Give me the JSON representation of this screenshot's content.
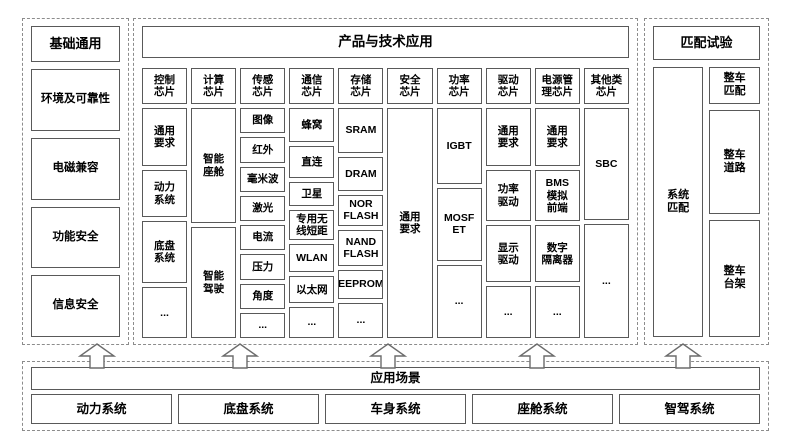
{
  "colors": {
    "background": "#ffffff",
    "box_border": "#595959",
    "dashed_border": "#8c8c8c",
    "text": "#000000"
  },
  "left_panel": {
    "title": "基础通用",
    "items": [
      "环境及可靠性",
      "电磁兼容",
      "功能安全",
      "信息安全"
    ]
  },
  "middle_panel": {
    "title": "产品与技术应用",
    "columns": [
      {
        "header": "控制\n芯片",
        "items": [
          "通用\n要求",
          "动力\n系统",
          "底盘\n系统",
          "..."
        ]
      },
      {
        "header": "计算\n芯片",
        "items": [
          "智能\n座舱",
          "智能\n驾驶"
        ]
      },
      {
        "header": "传感\n芯片",
        "items": [
          "图像",
          "红外",
          "毫米波",
          "激光",
          "电流",
          "压力",
          "角度",
          "..."
        ]
      },
      {
        "header": "通信\n芯片",
        "items": [
          "蜂窝",
          "直连",
          "卫星",
          "专用无\n线短距",
          "WLAN",
          "以太网",
          "..."
        ]
      },
      {
        "header": "存储\n芯片",
        "items": [
          "SRAM",
          "DRAM",
          "NOR\nFLASH",
          "NAND\nFLASH",
          "EEPROM",
          "..."
        ]
      },
      {
        "header": "安全\n芯片",
        "items": [
          "通用\n要求"
        ]
      },
      {
        "header": "功率\n芯片",
        "items": [
          "IGBT",
          "MOSF\nET",
          "..."
        ]
      },
      {
        "header": "驱动\n芯片",
        "items": [
          "通用\n要求",
          "功率\n驱动",
          "显示\n驱动",
          "..."
        ]
      },
      {
        "header": "电源管\n理芯片",
        "items": [
          "通用\n要求",
          "BMS\n模拟\n前端",
          "数字\n隔离器",
          "..."
        ]
      },
      {
        "header": "其他类\n芯片",
        "items": [
          "SBC",
          "..."
        ]
      }
    ]
  },
  "right_panel": {
    "title": "匹配试验",
    "system_item": "系统\n匹配",
    "items": [
      "整车\n匹配",
      "整车\n道路",
      "整车\n台架"
    ]
  },
  "bottom_panel": {
    "title": "应用场景",
    "items": [
      "动力系统",
      "底盘系统",
      "车身系统",
      "座舱系统",
      "智驾系统"
    ]
  }
}
